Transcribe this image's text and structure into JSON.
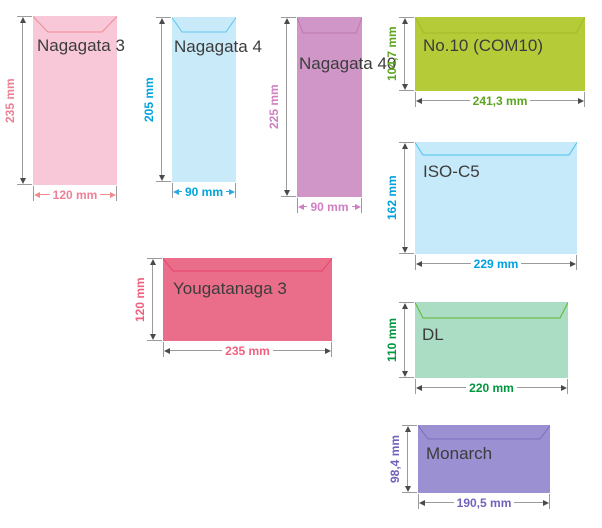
{
  "diagram": {
    "background": "#ffffff",
    "label_color": "#3c3c3c",
    "arrow_gray": "#9b9b9b",
    "arrowhead_dark": "#4a4a4a",
    "envelopes": [
      {
        "id": "nagagata-3",
        "label": "Nagagata 3",
        "orientation": "portrait",
        "height_label": "235 mm",
        "width_label": "120 mm",
        "height_mm": 235,
        "width_mm": 120,
        "fill": "#f8c8d9",
        "flap_color": "#ee8d8f",
        "dim_text_color": "#ee8095",
        "width_arrow_color": "#ee8d8f",
        "geometry": {
          "x": 33,
          "y": 16,
          "w": 84,
          "h": 169,
          "flap_depth": 16,
          "flap_inset": 15,
          "label_left": 4,
          "label_top": 20
        }
      },
      {
        "id": "nagagata-4",
        "label": "Nagagata 4",
        "orientation": "portrait",
        "height_label": "205 mm",
        "width_label": "90 mm",
        "height_mm": 205,
        "width_mm": 90,
        "fill": "#c9eaf9",
        "flap_color": "#5ec7ef",
        "dim_text_color": "#00a3dc",
        "width_arrow_color": "#2aa9e0",
        "geometry": {
          "x": 172,
          "y": 17,
          "w": 64,
          "h": 165,
          "flap_depth": 15,
          "flap_inset": 10,
          "label_left": 2,
          "label_top": 20
        }
      },
      {
        "id": "nagagata-40",
        "label": "Nagagata 40",
        "orientation": "portrait",
        "height_label": "225 mm",
        "width_label": "90 mm",
        "height_mm": 225,
        "width_mm": 90,
        "fill": "#d096c7",
        "flap_color": "#bc79b2",
        "dim_text_color": "#cf7fc2",
        "width_arrow_color": "#cf7fc2",
        "geometry": {
          "x": 297,
          "y": 17,
          "w": 65,
          "h": 180,
          "flap_depth": 16,
          "flap_inset": 6,
          "label_left": 2,
          "label_top": 37
        }
      },
      {
        "id": "no10-com10",
        "label": "No.10 (COM10)",
        "orientation": "landscape",
        "height_label": "104,7 mm",
        "width_label": "241,3 mm",
        "height_mm": 104.7,
        "width_mm": 241.3,
        "fill": "#b5cc38",
        "flap_color": "#a2b92a",
        "dim_text_color": "#5ba51e",
        "width_arrow_color": null,
        "geometry": {
          "x": 415,
          "y": 17,
          "w": 170,
          "h": 74,
          "flap_depth": 16,
          "flap_inset": 9,
          "label_left": 8,
          "label_top": 19
        }
      },
      {
        "id": "iso-c5",
        "label": "ISO-C5",
        "orientation": "landscape",
        "height_label": "162 mm",
        "width_label": "229 mm",
        "height_mm": 162,
        "width_mm": 229,
        "fill": "#c7eafa",
        "flap_color": "#46c2ef",
        "dim_text_color": "#00a1e0",
        "width_arrow_color": null,
        "geometry": {
          "x": 415,
          "y": 142,
          "w": 162,
          "h": 112,
          "flap_depth": 13,
          "flap_inset": 8,
          "label_left": 8,
          "label_top": 20
        }
      },
      {
        "id": "yougatanaga-3",
        "label": "Yougatanaga 3",
        "orientation": "landscape",
        "height_label": "120 mm",
        "width_label": "235 mm",
        "height_mm": 120,
        "width_mm": 235,
        "fill": "#ea6e8a",
        "flap_color": "#e4436a",
        "dim_text_color": "#f0617f",
        "width_arrow_color": null,
        "geometry": {
          "x": 163,
          "y": 258,
          "w": 169,
          "h": 83,
          "flap_depth": 13,
          "flap_inset": 10,
          "label_left": 10,
          "label_top": 21
        }
      },
      {
        "id": "dl",
        "label": "DL",
        "orientation": "landscape",
        "height_label": "110 mm",
        "width_label": "220 mm",
        "height_mm": 110,
        "width_mm": 220,
        "fill": "#abddc5",
        "flap_color": "#5cb82e",
        "dim_text_color": "#00973f",
        "width_arrow_color": null,
        "geometry": {
          "x": 415,
          "y": 302,
          "w": 153,
          "h": 76,
          "flap_depth": 16,
          "flap_inset": 8,
          "label_left": 7,
          "label_top": 23
        }
      },
      {
        "id": "monarch",
        "label": "Monarch",
        "orientation": "landscape",
        "height_label": "98,4 mm",
        "width_label": "190,5 mm",
        "height_mm": 98.4,
        "width_mm": 190.5,
        "fill": "#9a90d2",
        "flap_color": "#7e70c1",
        "dim_text_color": "#7163ba",
        "width_arrow_color": null,
        "geometry": {
          "x": 418,
          "y": 425,
          "w": 132,
          "h": 68,
          "flap_depth": 14,
          "flap_inset": 10,
          "label_left": 8,
          "label_top": 19
        }
      }
    ]
  }
}
